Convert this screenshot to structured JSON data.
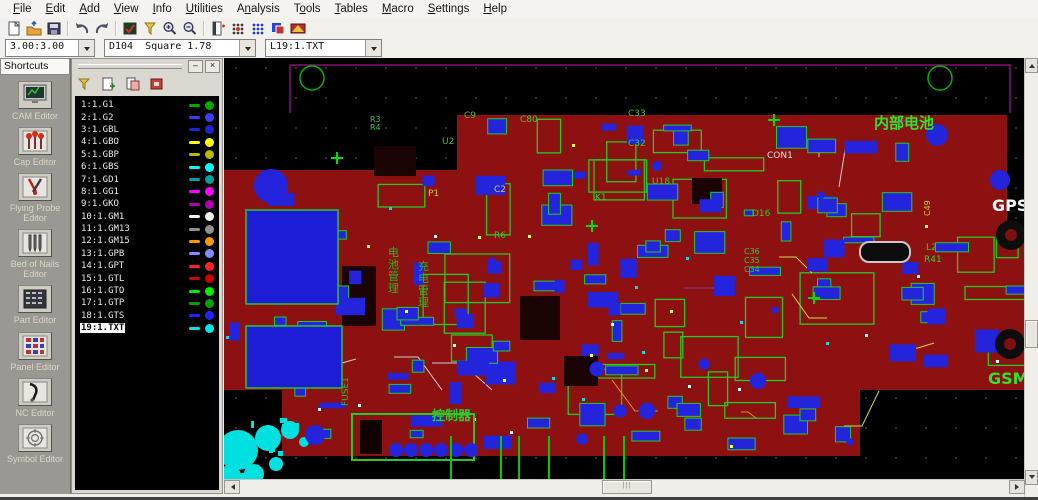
{
  "menu": {
    "items": [
      {
        "label": "File",
        "u": 0
      },
      {
        "label": "Edit",
        "u": 0
      },
      {
        "label": "Add",
        "u": 0
      },
      {
        "label": "View",
        "u": 0
      },
      {
        "label": "Info",
        "u": 0
      },
      {
        "label": "Utilities",
        "u": 0
      },
      {
        "label": "Analysis",
        "u": 1
      },
      {
        "label": "Tools",
        "u": 1
      },
      {
        "label": "Tables",
        "u": 0
      },
      {
        "label": "Macro",
        "u": 0
      },
      {
        "label": "Settings",
        "u": 0
      },
      {
        "label": "Help",
        "u": 0
      }
    ]
  },
  "toolbar": {
    "icons": [
      "new-file-icon",
      "import-icon",
      "save-icon",
      "undo-icon",
      "redo-icon",
      "redraw-icon",
      "highlight-icon",
      "zoom-in-icon",
      "zoom-out-icon",
      "board-layer-icon",
      "snap-grid-icon",
      "dot-grid-icon",
      "layer-colors-icon",
      "film-box-icon"
    ]
  },
  "combos": {
    "zoom_ratio": "3.00:3.00",
    "dcode": "D104  Square 1.78",
    "active_layer": "L19:1.TXT"
  },
  "shortcuts": {
    "title": "Shortcuts",
    "items": [
      {
        "label": "CAM Editor",
        "icon": "cam-editor-icon"
      },
      {
        "label": "Cap Editor",
        "icon": "cap-editor-icon"
      },
      {
        "label": "Flying Probe Editor",
        "icon": "flying-probe-editor-icon"
      },
      {
        "label": "Bed of Nails Editor",
        "icon": "bed-of-nails-editor-icon"
      },
      {
        "label": "Part Editor",
        "icon": "part-editor-icon"
      },
      {
        "label": "Panel Editor",
        "icon": "panel-editor-icon"
      },
      {
        "label": "NC Editor",
        "icon": "nc-editor-icon"
      },
      {
        "label": "Symbol Editor",
        "icon": "symbol-editor-icon"
      }
    ]
  },
  "layers_panel": {
    "minimize_label": "–",
    "close_label": "×",
    "toolbar_icons": [
      "highlight-layer-icon",
      "add-layer-icon",
      "copy-layer-icon",
      "remove-layer-icon"
    ],
    "layers": [
      {
        "name": "1:1.G1",
        "color": "#00a800"
      },
      {
        "name": "2:1.G2",
        "color": "#3c3cff"
      },
      {
        "name": "3:1.GBL",
        "color": "#2222cc"
      },
      {
        "name": "4:1.GBO",
        "color": "#ffff00"
      },
      {
        "name": "5:1.GBP",
        "color": "#b8b800"
      },
      {
        "name": "6:1.GBS",
        "color": "#00ffff"
      },
      {
        "name": "7:1.GD1",
        "color": "#00a0a0"
      },
      {
        "name": "8:1.GG1",
        "color": "#ff00ff"
      },
      {
        "name": "9:1.GKO",
        "color": "#b000b0"
      },
      {
        "name": "10:1.GM1",
        "color": "#f0f0f0"
      },
      {
        "name": "11:1.GM13",
        "color": "#909090"
      },
      {
        "name": "12:1.GM15",
        "color": "#ff9900"
      },
      {
        "name": "13:1.GPB",
        "color": "#8888ff"
      },
      {
        "name": "14:1.GPT",
        "color": "#ff2222"
      },
      {
        "name": "15:1.GTL",
        "color": "#cc0000"
      },
      {
        "name": "16:1.GTO",
        "color": "#00ee00"
      },
      {
        "name": "17:1.GTP",
        "color": "#00a000"
      },
      {
        "name": "18:1.GTS",
        "color": "#2222ff"
      },
      {
        "name": "19:1.TXT",
        "color": "#00e5e5",
        "selected": true
      }
    ]
  },
  "pcb": {
    "board_color": "#8d1111",
    "component_color": "#2424dd",
    "outline_color": "#27c927",
    "silk_cyan": "#00e0e0",
    "labels": [
      {
        "text": "内部电池",
        "x": 650,
        "y": 70,
        "color": "#2ee52e",
        "size": 15,
        "bold": true
      },
      {
        "text": "GPS",
        "x": 768,
        "y": 153,
        "color": "#ffffff",
        "size": 16,
        "bold": true
      },
      {
        "text": "GSM",
        "x": 764,
        "y": 326,
        "color": "#2ee52e",
        "size": 16,
        "bold": true
      },
      {
        "text": "控制器",
        "x": 208,
        "y": 362,
        "color": "#2ecc2e",
        "size": 13,
        "bold": true
      },
      {
        "text": "FUSE1",
        "x": 124,
        "y": 348,
        "color": "#2abb2a",
        "size": 9,
        "rotate": -90
      },
      {
        "text": "CON1",
        "x": 543,
        "y": 100,
        "color": "#e0e0e0",
        "size": 9
      },
      {
        "text": "电池管理",
        "x": 164,
        "y": 198,
        "color": "#22bb22",
        "size": 11,
        "vertical": true
      },
      {
        "text": "充电管理",
        "x": 194,
        "y": 212,
        "color": "#22bb22",
        "size": 11,
        "vertical": true
      },
      {
        "text": "C80",
        "x": 296,
        "y": 64,
        "color": "#33cc33",
        "size": 9
      },
      {
        "text": "C9",
        "x": 240,
        "y": 60,
        "color": "#33cc33",
        "size": 9
      },
      {
        "text": "C33",
        "x": 404,
        "y": 58,
        "color": "#33cc33",
        "size": 9
      },
      {
        "text": "C32",
        "x": 404,
        "y": 88,
        "color": "#33cc33",
        "size": 9
      },
      {
        "text": "U2",
        "x": 218,
        "y": 86,
        "color": "#33cc33",
        "size": 9
      },
      {
        "text": "R3",
        "x": 146,
        "y": 64,
        "color": "#33cc33",
        "size": 8
      },
      {
        "text": "R4",
        "x": 146,
        "y": 72,
        "color": "#33cc33",
        "size": 8
      },
      {
        "text": "P1",
        "x": 204,
        "y": 138,
        "color": "#cccc44",
        "size": 9
      },
      {
        "text": "C2",
        "x": 270,
        "y": 134,
        "color": "#cccc44",
        "size": 9
      },
      {
        "text": "R6",
        "x": 270,
        "y": 180,
        "color": "#33cc33",
        "size": 9
      },
      {
        "text": "U18",
        "x": 428,
        "y": 126,
        "color": "#33cc33",
        "size": 9
      },
      {
        "text": "D16",
        "x": 528,
        "y": 158,
        "color": "#33cc33",
        "size": 9
      },
      {
        "text": "K1",
        "x": 371,
        "y": 142,
        "color": "#33cc33",
        "size": 9
      },
      {
        "text": "L2",
        "x": 702,
        "y": 192,
        "color": "#33cc33",
        "size": 9
      },
      {
        "text": "R41",
        "x": 700,
        "y": 204,
        "color": "#33cc33",
        "size": 9
      },
      {
        "text": "C49",
        "x": 706,
        "y": 158,
        "color": "#cccc44",
        "size": 8,
        "rotate": -90
      },
      {
        "text": "C36",
        "x": 520,
        "y": 196,
        "color": "#33cc33",
        "size": 8
      },
      {
        "text": "C35",
        "x": 520,
        "y": 205,
        "color": "#33cc33",
        "size": 8
      },
      {
        "text": "C34",
        "x": 520,
        "y": 214,
        "color": "#33cc33",
        "size": 8
      }
    ]
  }
}
